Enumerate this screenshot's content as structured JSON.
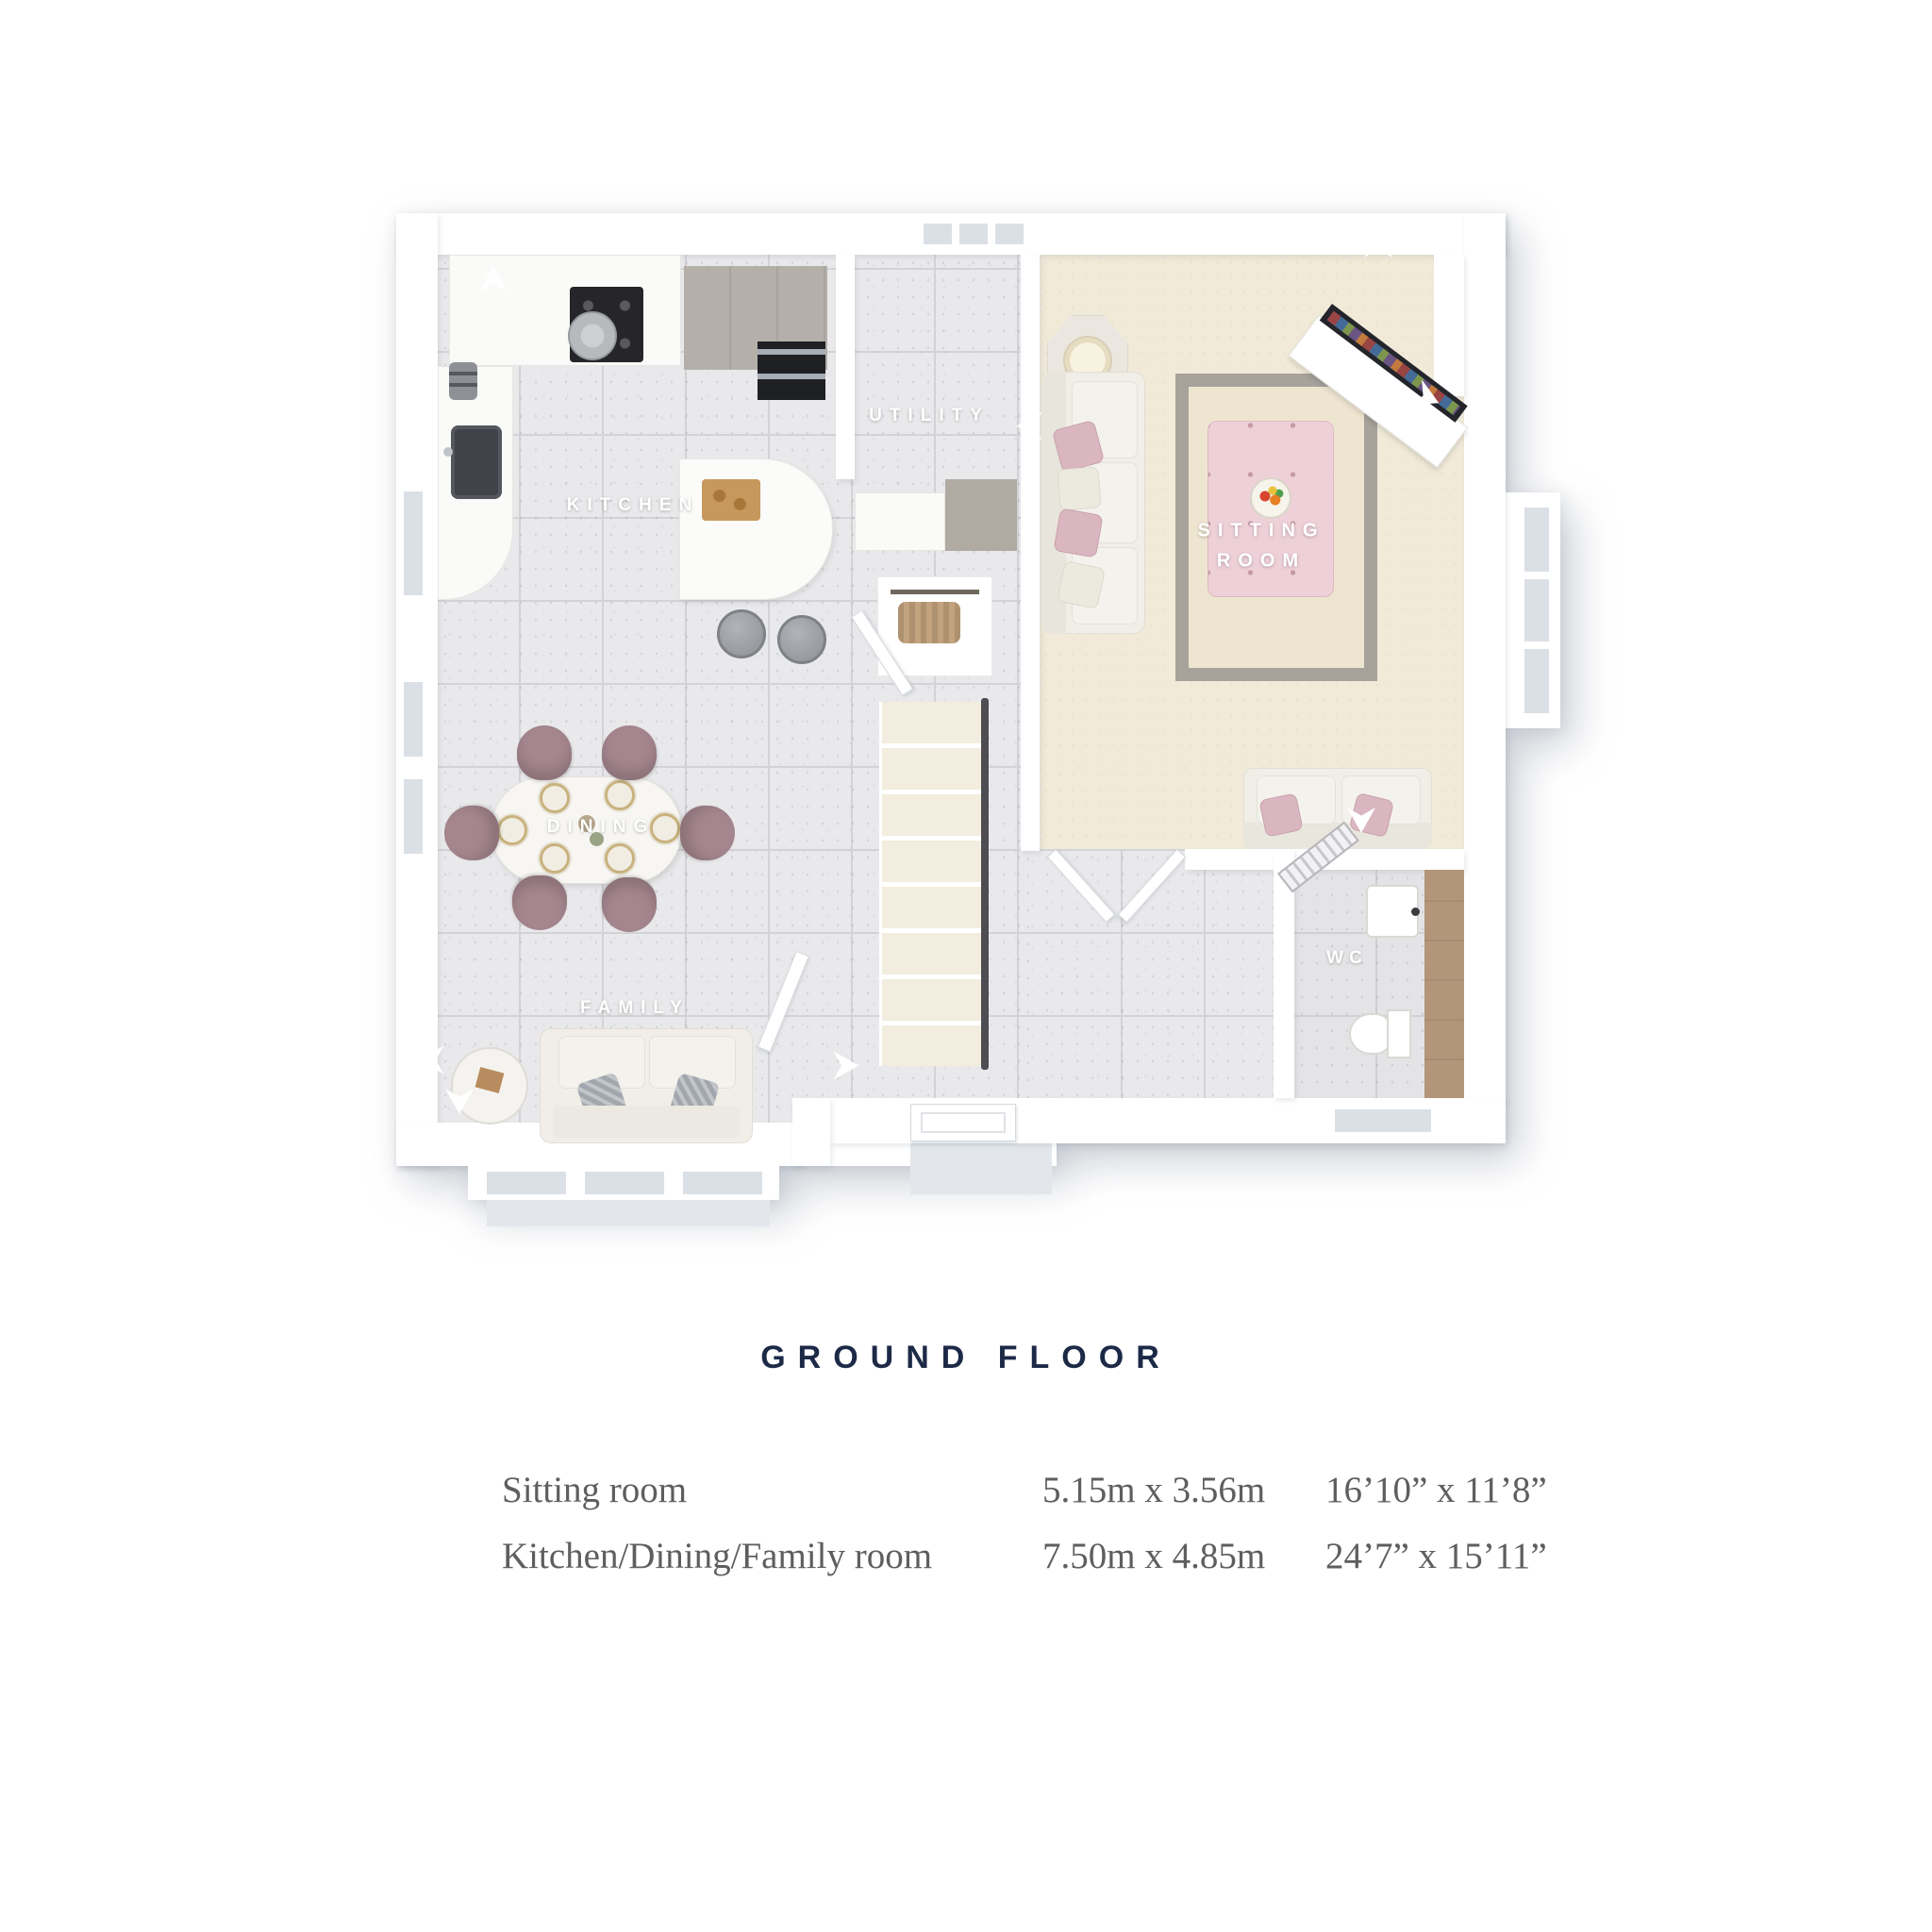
{
  "title": "GROUND FLOOR",
  "plan": {
    "room_labels": {
      "kitchen": "KITCHEN",
      "utility": "UTILITY",
      "sitting_room_line1": "SITTING",
      "sitting_room_line2": "ROOM",
      "dining": "DINING",
      "family": "FAMILY",
      "wc": "WC"
    }
  },
  "dimensions_table": {
    "rows": [
      {
        "room": "Sitting room",
        "metric": "5.15m x 3.56m",
        "imperial": "16’10” x 11’8”"
      },
      {
        "room": "Kitchen/Dining/Family room",
        "metric": "7.50m x 4.85m",
        "imperial": "24’7” x 15’11”"
      }
    ]
  },
  "colors": {
    "title_navy": "#1c2947",
    "table_text_grey": "#5d5e60",
    "label_white": "#ffffff",
    "ottoman_pink": "#eed0d8",
    "chair_mauve": "#a5868e",
    "pillow_pink": "#d9b6c0",
    "floor_tile_grey": "#e9e9eb",
    "carpet_cream": "#f1ead9",
    "wood_vanity": "#b3967a"
  }
}
